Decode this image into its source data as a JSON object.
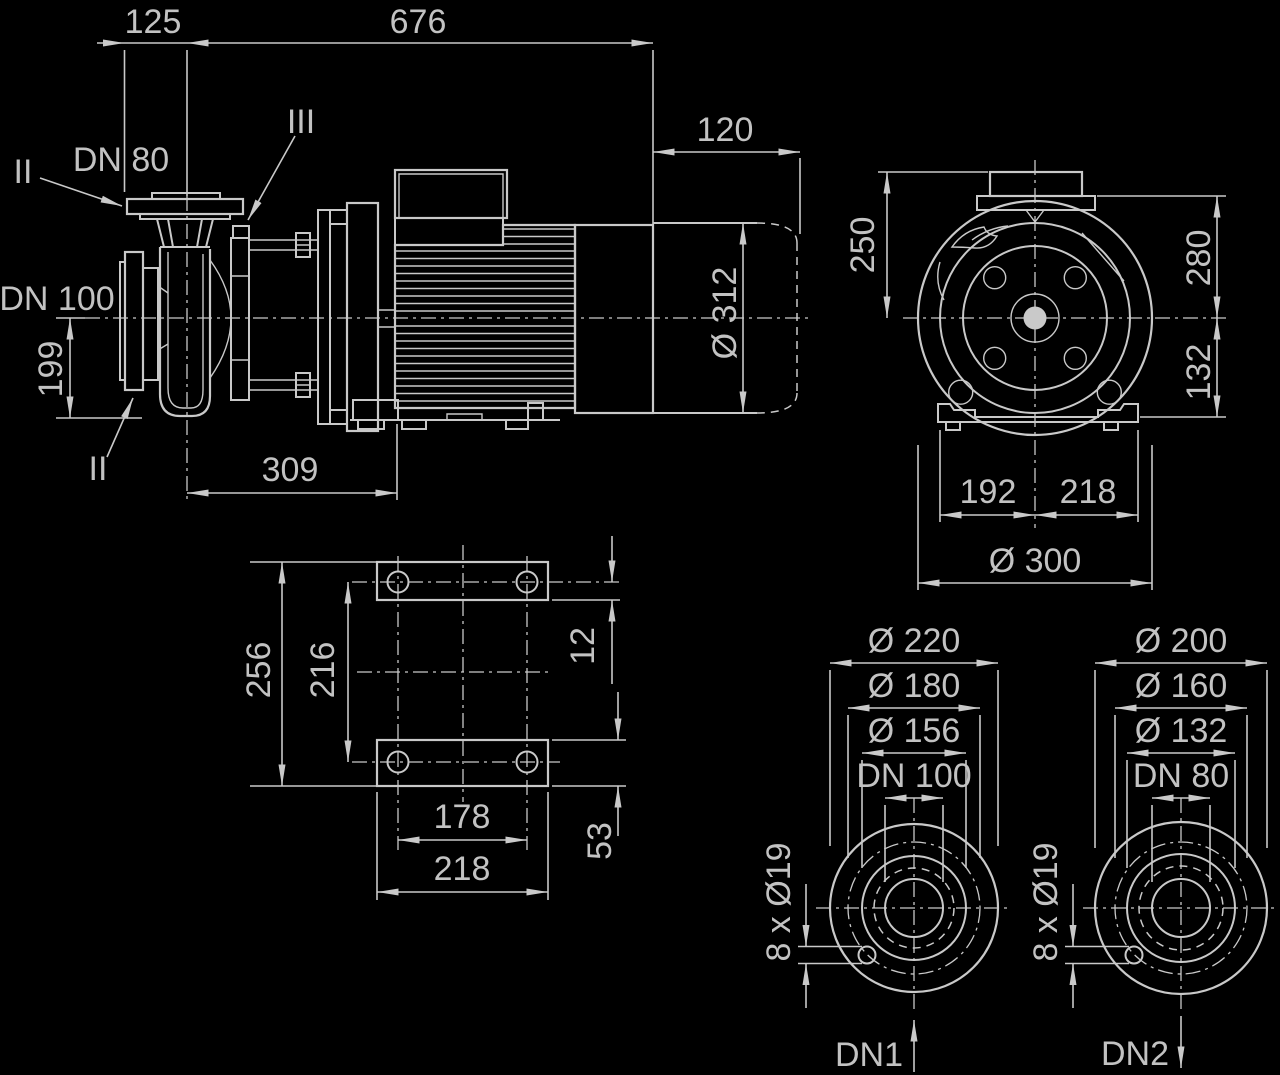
{
  "drawing_type": "pump-dimension-drawing",
  "colors": {
    "background": "#000000",
    "line": "#c9c9c9",
    "text": "#c2c2c2"
  },
  "side": {
    "d125": "125",
    "d676": "676",
    "d120": "120",
    "d199": "199",
    "d309": "309",
    "d312": "Ø 312",
    "dn80": "DN 80",
    "dn100": "DN 100",
    "ii_top": "II",
    "ii_bottom": "II",
    "iii": "III"
  },
  "front": {
    "d250": "250",
    "d280": "280",
    "d132": "132",
    "d192": "192",
    "d218": "218",
    "d300": "Ø 300"
  },
  "base": {
    "d256": "256",
    "d216": "216",
    "d12": "12",
    "d53": "53",
    "d178": "178",
    "d218": "218"
  },
  "flange_dn100": {
    "d220": "Ø 220",
    "d180": "Ø 180",
    "d156": "Ø 156",
    "dn": "DN 100",
    "holes": "8 x Ø19",
    "port": "DN1"
  },
  "flange_dn80": {
    "d200": "Ø 200",
    "d160": "Ø 160",
    "d132": "Ø 132",
    "dn": "DN 80",
    "holes": "8 x Ø19",
    "port": "DN2"
  }
}
